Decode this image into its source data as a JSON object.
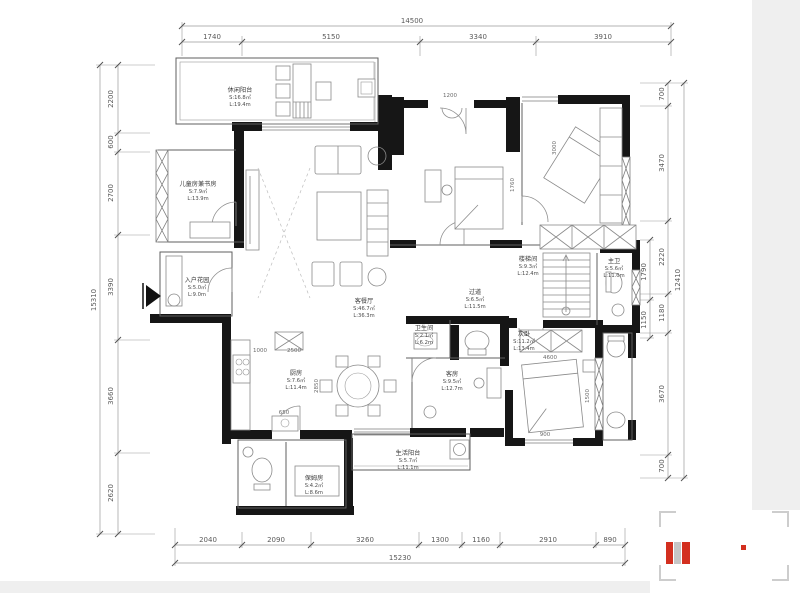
{
  "dims": {
    "top": {
      "total": "14500",
      "segments": [
        "1740",
        "5150",
        "3340",
        "3910"
      ]
    },
    "bottom": {
      "total": "15230",
      "segments": [
        "2040",
        "2090",
        "3260",
        "1300",
        "1160",
        "2910",
        "890"
      ]
    },
    "left": {
      "total": "15310",
      "segments": [
        "2200",
        "600",
        "2700",
        "3390",
        "3660",
        "2620"
      ]
    },
    "right": {
      "total": "12410",
      "segments": [
        "700",
        "3470",
        "2220",
        "1180",
        "3670",
        "700"
      ],
      "inner": [
        "1790",
        "1150"
      ]
    }
  },
  "rooms": [
    {
      "name": "休闲阳台",
      "area": "S:16.8㎡",
      "len": "L:19.4m"
    },
    {
      "name": "儿童房兼书房",
      "area": "S:7.9㎡",
      "len": "L:13.9m"
    },
    {
      "name": "入户花园",
      "area": "S:5.0㎡",
      "len": "L:9.0m"
    },
    {
      "name": "客餐厅",
      "area": "S:46.7㎡",
      "len": "L:36.3m"
    },
    {
      "name": "过道",
      "area": "S:6.5㎡",
      "len": "L:11.5m"
    },
    {
      "name": "楼梯间",
      "area": "S:9.3㎡",
      "len": "L:12.4m"
    },
    {
      "name": "主卫",
      "area": "S:5.6㎡",
      "len": "L:11.0m"
    },
    {
      "name": "厨房",
      "area": "S:7.6㎡",
      "len": "L:11.4m"
    },
    {
      "name": "客房",
      "area": "S:9.5㎡",
      "len": "L:12.7m"
    },
    {
      "name": "卫生间",
      "area": "S:2.1㎡",
      "len": "L:6.2m"
    },
    {
      "name": "次卧",
      "area": "S:11.2㎡",
      "len": "L:13.4m"
    },
    {
      "name": "生活阳台",
      "area": "S:5.7㎡",
      "len": "L:11.1m"
    },
    {
      "name": "保姆房",
      "area": "S:4.2㎡",
      "len": "L:8.6m"
    }
  ],
  "inner_dims": [
    "1200",
    "3000",
    "1760",
    "4600",
    "1500",
    "900",
    "1000",
    "2500",
    "2850",
    "650"
  ],
  "logo": {
    "red": "#d32f1f",
    "gray": "#c6c6c6"
  }
}
